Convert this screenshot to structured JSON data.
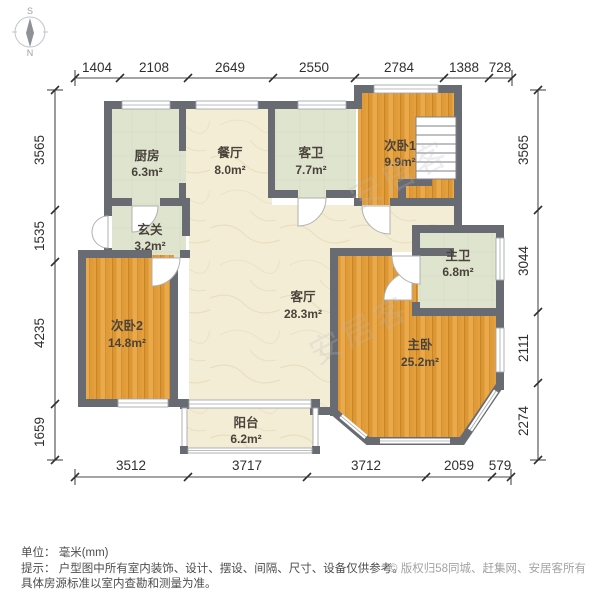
{
  "compass": {
    "south": "S",
    "north": "N"
  },
  "rooms": {
    "kitchen": {
      "label": "厨房",
      "area": "6.3m²"
    },
    "dining": {
      "label": "餐厅",
      "area": "8.0m²"
    },
    "guest_bath": {
      "label": "客卫",
      "area": "7.7m²"
    },
    "bedroom1": {
      "label": "次卧1",
      "area": "9.9m²"
    },
    "foyer": {
      "label": "玄关",
      "area": "3.2m²"
    },
    "master_bath": {
      "label": "主卫",
      "area": "6.8m²"
    },
    "bedroom2": {
      "label": "次卧2",
      "area": "14.8m²"
    },
    "living": {
      "label": "客厅",
      "area": "28.3m²"
    },
    "master_bedroom": {
      "label": "主卧",
      "area": "25.2m²"
    },
    "balcony": {
      "label": "阳台",
      "area": "6.2m²"
    }
  },
  "dimensions": {
    "top": [
      "1404",
      "2108",
      "2649",
      "2550",
      "2784",
      "1388",
      "728"
    ],
    "left": [
      "3565",
      "1535",
      "4235",
      "1659"
    ],
    "right": [
      "3565",
      "3044",
      "2111",
      "2274"
    ],
    "bottom": [
      "3512",
      "3717",
      "3712",
      "2059",
      "579"
    ]
  },
  "footer": {
    "unit": "单位： 毫米(mm)",
    "tip1": "提示： 户型图中所有室内装饰、设计、摆设、间隔、尺寸、设备仅供参考。",
    "tip2": "具体房源标准以室内查勘和测量为准。",
    "copyright": "© 版权归58同城、赶集网、安居客所有"
  },
  "watermark": "安居客",
  "colors": {
    "wall": "#686b72",
    "wood": "#e4a03c",
    "tile": "#dfe4cf",
    "marble": "#f4edd6"
  }
}
